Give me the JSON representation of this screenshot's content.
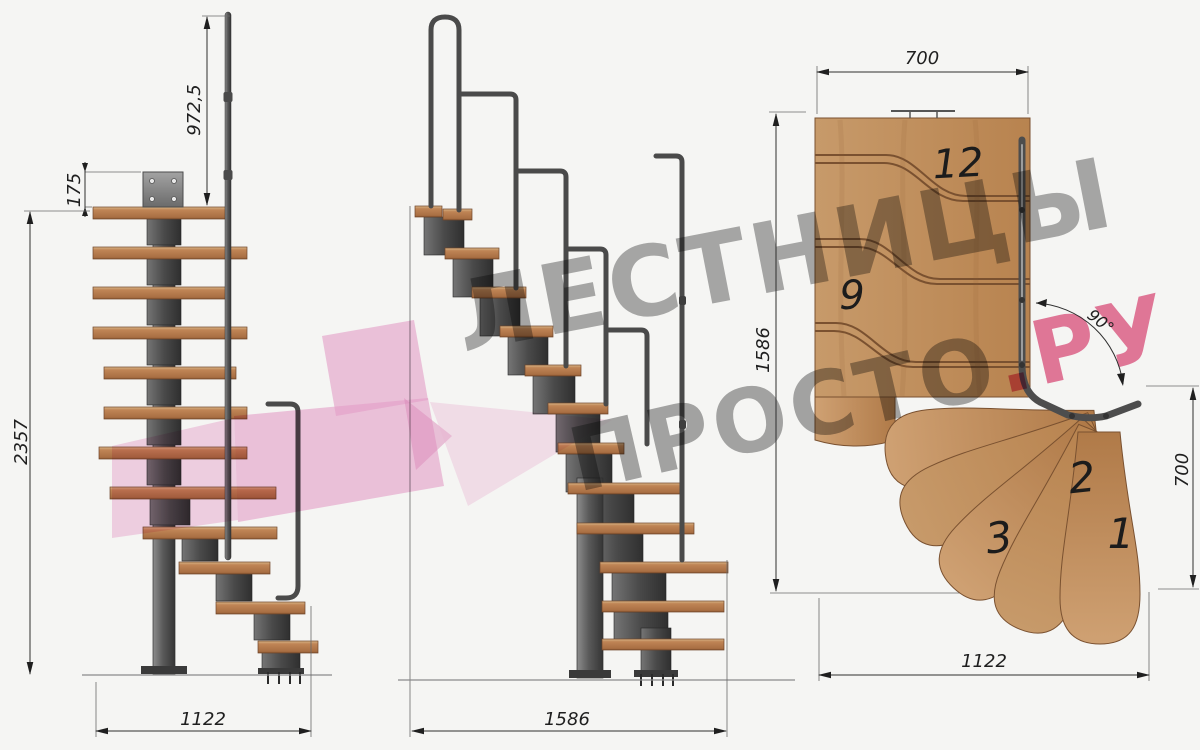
{
  "drawing": {
    "watermark": {
      "line1": "ЛЕСТНИЦЫ",
      "line2_gray": "ПРОСТО",
      "line2_pink": ".РУ",
      "gray_color": "#8c8c8c",
      "pink_color": "#e14f7e",
      "arrow_color": "#eda4d0"
    },
    "front_view": {
      "dim_handrail_height": "972,5",
      "dim_plate_height": "175",
      "dim_total_height": "2357",
      "dim_width": "1122"
    },
    "side_view": {
      "dim_length": "1586"
    },
    "plan_view": {
      "dim_flight_width": "700",
      "dim_length": "1586",
      "dim_turn_angle": "90°",
      "dim_exit_width": "700",
      "dim_total_length": "1122",
      "step_numbers": [
        "12",
        "9",
        "3",
        "2",
        "1"
      ]
    },
    "colors": {
      "wood": "#c3905f",
      "metal": "#4d4d4d",
      "background": "#f5f5f3"
    }
  }
}
